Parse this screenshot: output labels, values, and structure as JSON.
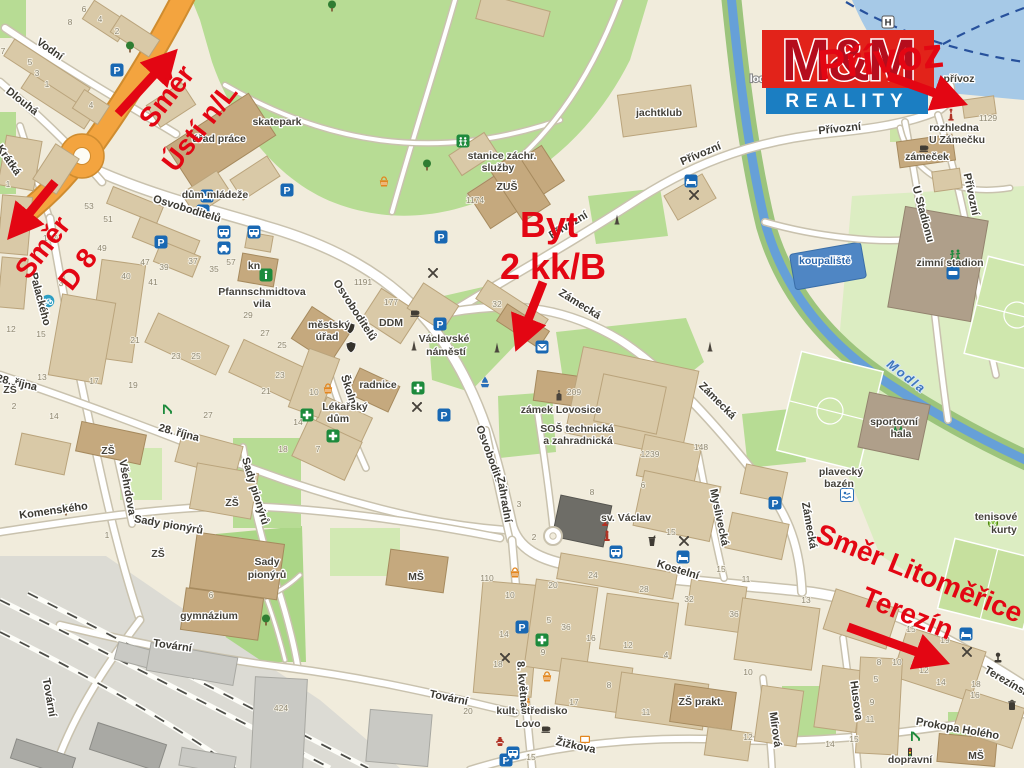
{
  "logo": {
    "mm": "M&M",
    "reality": "REALITY",
    "red": "#e2231a",
    "mm_fill": "#b50d1d",
    "blue": "#1b7ec2"
  },
  "annotations": {
    "color": "#e30613",
    "texts": [
      {
        "t": "Směr",
        "x": 174,
        "y": 102,
        "r": -52,
        "s": 28
      },
      {
        "t": "Ústí n/L",
        "x": 207,
        "y": 133,
        "r": -52,
        "s": 28
      },
      {
        "t": "Směr",
        "x": 50,
        "y": 253,
        "r": -52,
        "s": 28
      },
      {
        "t": "D 8",
        "x": 85,
        "y": 275,
        "r": -52,
        "s": 28
      },
      {
        "t": "Byt",
        "x": 549,
        "y": 237,
        "r": 0,
        "s": 36
      },
      {
        "t": "2 kk/B",
        "x": 553,
        "y": 279,
        "r": 0,
        "s": 36
      },
      {
        "t": "Přívoz",
        "x": 882,
        "y": 73,
        "r": -6,
        "s": 42
      },
      {
        "t": "Směr Litoměřice",
        "x": 916,
        "y": 582,
        "r": 22,
        "s": 28
      },
      {
        "t": "Terezín",
        "x": 904,
        "y": 622,
        "r": 22,
        "s": 28
      }
    ],
    "arrows": [
      {
        "x1": 118,
        "y1": 114,
        "x2": 162,
        "y2": 66
      },
      {
        "x1": 55,
        "y1": 182,
        "x2": 22,
        "y2": 222
      },
      {
        "x1": 543,
        "y1": 282,
        "x2": 524,
        "y2": 330
      },
      {
        "x1": 888,
        "y1": 76,
        "x2": 946,
        "y2": 97
      },
      {
        "x1": 848,
        "y1": 627,
        "x2": 928,
        "y2": 656
      }
    ]
  },
  "map": {
    "street_labels": [
      {
        "t": "Vodní",
        "x": 48,
        "y": 52,
        "r": 35
      },
      {
        "t": "Dlouhá",
        "x": 20,
        "y": 104,
        "r": 38
      },
      {
        "t": "Krátká",
        "x": 6,
        "y": 162,
        "r": 55
      },
      {
        "t": "Palackého",
        "x": 37,
        "y": 300,
        "r": 75
      },
      {
        "t": "Osvoboditelů",
        "x": 186,
        "y": 212,
        "r": 17
      },
      {
        "t": "Osvoboditelů",
        "x": 352,
        "y": 312,
        "r": 57
      },
      {
        "t": "Osvoboditelů",
        "x": 488,
        "y": 460,
        "r": 70
      },
      {
        "t": "28. října",
        "x": 16,
        "y": 386,
        "r": 13
      },
      {
        "t": "28. října",
        "x": 178,
        "y": 436,
        "r": 15
      },
      {
        "t": "Komenského",
        "x": 54,
        "y": 514,
        "r": -8
      },
      {
        "t": "Všehrdova",
        "x": 124,
        "y": 488,
        "r": 80
      },
      {
        "t": "Sady pionýrů",
        "x": 168,
        "y": 528,
        "r": 10
      },
      {
        "t": "Sady pionýrů",
        "x": 252,
        "y": 492,
        "r": 73
      },
      {
        "t": "Tovární",
        "x": 46,
        "y": 698,
        "r": 80
      },
      {
        "t": "Tovární",
        "x": 172,
        "y": 649,
        "r": 8
      },
      {
        "t": "Tovární",
        "x": 448,
        "y": 701,
        "r": 12
      },
      {
        "t": "Zahradní",
        "x": 501,
        "y": 500,
        "r": 80
      },
      {
        "t": "Školní",
        "x": 346,
        "y": 392,
        "r": 72
      },
      {
        "t": "Kostelní",
        "x": 677,
        "y": 573,
        "r": 17
      },
      {
        "t": "Myslivecká",
        "x": 716,
        "y": 518,
        "r": 78
      },
      {
        "t": "Zámecká",
        "x": 578,
        "y": 307,
        "r": 32
      },
      {
        "t": "Zámecká",
        "x": 715,
        "y": 403,
        "r": 45
      },
      {
        "t": "Zámecká",
        "x": 806,
        "y": 526,
        "r": 80
      },
      {
        "t": "Přívozní",
        "x": 570,
        "y": 228,
        "r": -31
      },
      {
        "t": "Přívozní",
        "x": 702,
        "y": 157,
        "r": -23
      },
      {
        "t": "Přívozní",
        "x": 840,
        "y": 132,
        "r": -6
      },
      {
        "t": "Přívozní",
        "x": 968,
        "y": 195,
        "r": 78
      },
      {
        "t": "U Stadionu",
        "x": 920,
        "y": 215,
        "r": 75
      },
      {
        "t": "Husova",
        "x": 853,
        "y": 701,
        "r": 82
      },
      {
        "t": "Mírová",
        "x": 772,
        "y": 730,
        "r": 82
      },
      {
        "t": "Prokopa Holého",
        "x": 957,
        "y": 732,
        "r": 10
      },
      {
        "t": "Terezínská",
        "x": 1008,
        "y": 686,
        "r": 30
      },
      {
        "t": "8. května",
        "x": 519,
        "y": 685,
        "r": 85
      },
      {
        "t": "Žižkova",
        "x": 575,
        "y": 749,
        "r": 12
      }
    ],
    "poi_labels": [
      {
        "t": "skatepark",
        "x": 277,
        "y": 125
      },
      {
        "t": "úřad práce",
        "x": 219,
        "y": 142
      },
      {
        "t": "dům mládeže",
        "x": 215,
        "y": 198
      },
      {
        "t": "stanice záchr.",
        "x": 502,
        "y": 159
      },
      {
        "t": "služby",
        "x": 498,
        "y": 171
      },
      {
        "t": "ZUŠ",
        "x": 507,
        "y": 190
      },
      {
        "t": "jachtklub",
        "x": 659,
        "y": 116
      },
      {
        "t": "loděnice",
        "x": 771,
        "y": 82,
        "c": "white"
      },
      {
        "t": "přívoz",
        "x": 959,
        "y": 82
      },
      {
        "t": "rozhledna",
        "x": 954,
        "y": 131
      },
      {
        "t": "U Zámečku",
        "x": 957,
        "y": 143
      },
      {
        "t": "zámeček",
        "x": 927,
        "y": 160
      },
      {
        "t": "koupaliště",
        "x": 825,
        "y": 264,
        "c": "blue"
      },
      {
        "t": "zimní stadion",
        "x": 950,
        "y": 266
      },
      {
        "t": "Pfannschmidtova",
        "x": 262,
        "y": 295
      },
      {
        "t": "vila",
        "x": 262,
        "y": 307
      },
      {
        "t": "kn",
        "x": 254,
        "y": 269
      },
      {
        "t": "městský",
        "x": 329,
        "y": 328
      },
      {
        "t": "úřad",
        "x": 327,
        "y": 340
      },
      {
        "t": "DDM",
        "x": 391,
        "y": 326
      },
      {
        "t": "Václavské",
        "x": 444,
        "y": 342
      },
      {
        "t": "náměstí",
        "x": 446,
        "y": 355
      },
      {
        "t": "radnice",
        "x": 378,
        "y": 388
      },
      {
        "t": "Lékařský",
        "x": 345,
        "y": 410
      },
      {
        "t": "dům",
        "x": 338,
        "y": 422
      },
      {
        "t": "zámek Lovosice",
        "x": 561,
        "y": 413
      },
      {
        "t": "SOŠ technická",
        "x": 577,
        "y": 432
      },
      {
        "t": "a zahradnická",
        "x": 578,
        "y": 444
      },
      {
        "t": "sv. Václav",
        "x": 626,
        "y": 521
      },
      {
        "t": "gymnázium",
        "x": 209,
        "y": 619
      },
      {
        "t": "ZŠ",
        "x": 108,
        "y": 454
      },
      {
        "t": "ZŠ",
        "x": 232,
        "y": 506
      },
      {
        "t": "ZŠ",
        "x": 158,
        "y": 557
      },
      {
        "t": "ZŠ",
        "x": 10,
        "y": 393
      },
      {
        "t": "ZŠ prakt.",
        "x": 701,
        "y": 705
      },
      {
        "t": "MŠ",
        "x": 416,
        "y": 580
      },
      {
        "t": "MŠ",
        "x": 976,
        "y": 759
      },
      {
        "t": "kult. středisko",
        "x": 532,
        "y": 714
      },
      {
        "t": "Lovo",
        "x": 528,
        "y": 727
      },
      {
        "t": "plavecký",
        "x": 841,
        "y": 475
      },
      {
        "t": "bazén",
        "x": 839,
        "y": 487
      },
      {
        "t": "sportovní",
        "x": 894,
        "y": 425
      },
      {
        "t": "hala",
        "x": 901,
        "y": 437
      },
      {
        "t": "tenisové",
        "x": 996,
        "y": 520
      },
      {
        "t": "kurty",
        "x": 1004,
        "y": 533
      },
      {
        "t": "dopravní",
        "x": 910,
        "y": 763
      },
      {
        "t": "Sady",
        "x": 267,
        "y": 565
      },
      {
        "t": "pionýrů",
        "x": 267,
        "y": 578
      },
      {
        "t": "Modla",
        "x": 904,
        "y": 380,
        "c": "river",
        "r": 38
      }
    ],
    "numbers": [
      [
        "7",
        3,
        54
      ],
      [
        "5",
        30,
        65
      ],
      [
        "3",
        37,
        76
      ],
      [
        "1",
        47,
        87
      ],
      [
        "6",
        84,
        12
      ],
      [
        "8",
        70,
        25
      ],
      [
        "4",
        100,
        22
      ],
      [
        "2",
        117,
        34
      ],
      [
        "4",
        91,
        108
      ],
      [
        "1",
        8,
        187
      ],
      [
        "147",
        50,
        241
      ],
      [
        "53",
        89,
        209
      ],
      [
        "51",
        108,
        222
      ],
      [
        "49",
        102,
        251
      ],
      [
        "47",
        145,
        265
      ],
      [
        "3",
        61,
        286
      ],
      [
        "15",
        41,
        337
      ],
      [
        "13",
        42,
        380
      ],
      [
        "12",
        11,
        332
      ],
      [
        "21",
        135,
        343
      ],
      [
        "23",
        176,
        359
      ],
      [
        "25",
        196,
        359
      ],
      [
        "19",
        133,
        388
      ],
      [
        "17",
        94,
        384
      ],
      [
        "27",
        208,
        418
      ],
      [
        "14",
        54,
        419
      ],
      [
        "2",
        14,
        409
      ],
      [
        "37",
        193,
        264
      ],
      [
        "35",
        214,
        272
      ],
      [
        "39",
        164,
        270
      ],
      [
        "41",
        153,
        285
      ],
      [
        "57",
        231,
        265
      ],
      [
        "40",
        126,
        279
      ],
      [
        "29",
        248,
        318
      ],
      [
        "27",
        265,
        336
      ],
      [
        "25",
        282,
        348
      ],
      [
        "23",
        280,
        378
      ],
      [
        "21",
        266,
        394
      ],
      [
        "10",
        314,
        395
      ],
      [
        "14",
        298,
        425
      ],
      [
        "18",
        283,
        452
      ],
      [
        "7",
        318,
        452
      ],
      [
        "1191",
        363,
        285
      ],
      [
        "177",
        391,
        305
      ],
      [
        "32",
        497,
        307
      ],
      [
        "76",
        520,
        330
      ],
      [
        "1174",
        475,
        203
      ],
      [
        "209",
        574,
        395
      ],
      [
        "4",
        561,
        432
      ],
      [
        "148",
        701,
        450
      ],
      [
        "1239",
        650,
        457
      ],
      [
        "6",
        643,
        488
      ],
      [
        "8",
        592,
        495
      ],
      [
        "3",
        519,
        507
      ],
      [
        "2",
        534,
        540
      ],
      [
        "15",
        671,
        535
      ],
      [
        "15",
        721,
        572
      ],
      [
        "11",
        746,
        582
      ],
      [
        "13",
        806,
        603
      ],
      [
        "24",
        593,
        578
      ],
      [
        "28",
        644,
        592
      ],
      [
        "32",
        689,
        602
      ],
      [
        "36",
        734,
        617
      ],
      [
        "20",
        553,
        588
      ],
      [
        "110",
        487,
        581
      ],
      [
        "10",
        510,
        598
      ],
      [
        "14",
        504,
        637
      ],
      [
        "18",
        498,
        667
      ],
      [
        "9",
        543,
        655
      ],
      [
        "5",
        549,
        623
      ],
      [
        "36",
        566,
        630
      ],
      [
        "16",
        591,
        641
      ],
      [
        "12",
        628,
        648
      ],
      [
        "4",
        666,
        658
      ],
      [
        "8",
        609,
        688
      ],
      [
        "17",
        574,
        705
      ],
      [
        "11",
        646,
        715
      ],
      [
        "20",
        468,
        714
      ],
      [
        "424",
        281,
        711
      ],
      [
        "15",
        531,
        760
      ],
      [
        "15",
        911,
        632
      ],
      [
        "19",
        945,
        643
      ],
      [
        "18",
        976,
        687
      ],
      [
        "16",
        975,
        698
      ],
      [
        "10",
        748,
        675
      ],
      [
        "8",
        879,
        665
      ],
      [
        "10",
        897,
        665
      ],
      [
        "12",
        924,
        673
      ],
      [
        "5",
        876,
        682
      ],
      [
        "14",
        941,
        685
      ],
      [
        "9",
        872,
        705
      ],
      [
        "11",
        870,
        722
      ],
      [
        "15",
        854,
        742
      ],
      [
        "14",
        830,
        747
      ],
      [
        "12",
        748,
        740
      ],
      [
        "1129",
        988,
        121
      ],
      [
        "6",
        211,
        598
      ],
      [
        "1",
        107,
        538
      ]
    ],
    "icons": [
      {
        "k": "parking",
        "x": 117,
        "y": 70
      },
      {
        "k": "parking",
        "x": 287,
        "y": 190
      },
      {
        "k": "parking",
        "x": 203,
        "y": 211
      },
      {
        "k": "parking",
        "x": 161,
        "y": 242
      },
      {
        "k": "parking",
        "x": 441,
        "y": 237
      },
      {
        "k": "parking",
        "x": 440,
        "y": 324
      },
      {
        "k": "parking",
        "x": 444,
        "y": 415
      },
      {
        "k": "parking",
        "x": 775,
        "y": 503
      },
      {
        "k": "parking",
        "x": 506,
        "y": 760
      },
      {
        "k": "parking",
        "x": 522,
        "y": 627
      },
      {
        "k": "bus",
        "x": 224,
        "y": 232
      },
      {
        "k": "bus",
        "x": 254,
        "y": 232
      },
      {
        "k": "bus",
        "x": 616,
        "y": 552
      },
      {
        "k": "bus",
        "x": 513,
        "y": 753
      },
      {
        "k": "car",
        "x": 224,
        "y": 248
      },
      {
        "k": "restaurant",
        "x": 433,
        "y": 273
      },
      {
        "k": "restaurant",
        "x": 694,
        "y": 195
      },
      {
        "k": "restaurant",
        "x": 417,
        "y": 407
      },
      {
        "k": "restaurant",
        "x": 684,
        "y": 541
      },
      {
        "k": "restaurant",
        "x": 505,
        "y": 658
      },
      {
        "k": "restaurant",
        "x": 967,
        "y": 652
      },
      {
        "k": "pharmacy",
        "x": 307,
        "y": 415
      },
      {
        "k": "pharmacy",
        "x": 333,
        "y": 436
      },
      {
        "k": "pharmacy",
        "x": 418,
        "y": 388
      },
      {
        "k": "pharmacy",
        "x": 542,
        "y": 640
      },
      {
        "k": "basket",
        "x": 328,
        "y": 389
      },
      {
        "k": "basket",
        "x": 515,
        "y": 573
      },
      {
        "k": "basket",
        "x": 547,
        "y": 677
      },
      {
        "k": "basket",
        "x": 384,
        "y": 182
      },
      {
        "k": "coffee",
        "x": 415,
        "y": 312
      },
      {
        "k": "coffee",
        "x": 924,
        "y": 147
      },
      {
        "k": "coffee",
        "x": 546,
        "y": 728
      },
      {
        "k": "bed",
        "x": 691,
        "y": 181
      },
      {
        "k": "bed",
        "x": 207,
        "y": 196
      },
      {
        "k": "bed",
        "x": 683,
        "y": 557
      },
      {
        "k": "bed",
        "x": 966,
        "y": 634
      },
      {
        "k": "info",
        "x": 266,
        "y": 275
      },
      {
        "k": "envelope",
        "x": 542,
        "y": 347
      },
      {
        "k": "fountain",
        "x": 485,
        "y": 382
      },
      {
        "k": "church",
        "x": 559,
        "y": 395
      },
      {
        "k": "obelisk",
        "x": 414,
        "y": 345
      },
      {
        "k": "obelisk",
        "x": 497,
        "y": 347
      },
      {
        "k": "obelisk",
        "x": 617,
        "y": 219
      },
      {
        "k": "obelisk",
        "x": 710,
        "y": 346
      },
      {
        "k": "monument",
        "x": 605,
        "y": 521
      },
      {
        "k": "monument",
        "x": 607,
        "y": 536
      },
      {
        "k": "shield",
        "x": 350,
        "y": 328
      },
      {
        "k": "shield",
        "x": 351,
        "y": 347
      },
      {
        "k": "tree",
        "x": 66,
        "y": 510
      },
      {
        "k": "tree",
        "x": 266,
        "y": 620
      },
      {
        "k": "tree",
        "x": 130,
        "y": 47
      },
      {
        "k": "tree",
        "x": 332,
        "y": 6
      },
      {
        "k": "tree",
        "x": 427,
        "y": 165
      },
      {
        "k": "park",
        "x": 463,
        "y": 141
      },
      {
        "k": "bike",
        "x": 48,
        "y": 301
      },
      {
        "k": "slide",
        "x": 167,
        "y": 409
      },
      {
        "k": "slide",
        "x": 915,
        "y": 736
      },
      {
        "k": "light",
        "x": 910,
        "y": 753
      },
      {
        "k": "swim",
        "x": 847,
        "y": 495
      },
      {
        "k": "tennis",
        "x": 993,
        "y": 523
      },
      {
        "k": "sports",
        "x": 955,
        "y": 255
      },
      {
        "k": "sports",
        "x": 898,
        "y": 426
      },
      {
        "k": "rink",
        "x": 953,
        "y": 273
      },
      {
        "k": "screen",
        "x": 585,
        "y": 740
      },
      {
        "k": "trash",
        "x": 1012,
        "y": 705
      },
      {
        "k": "joystick",
        "x": 998,
        "y": 658
      },
      {
        "k": "hydrant",
        "x": 500,
        "y": 741
      },
      {
        "k": "culture",
        "x": 525,
        "y": 703
      },
      {
        "k": "drink",
        "x": 652,
        "y": 541
      },
      {
        "k": "tower",
        "x": 948,
        "y": 95
      },
      {
        "k": "tower",
        "x": 951,
        "y": 114
      },
      {
        "k": "hsign",
        "x": 888,
        "y": 22
      }
    ]
  }
}
